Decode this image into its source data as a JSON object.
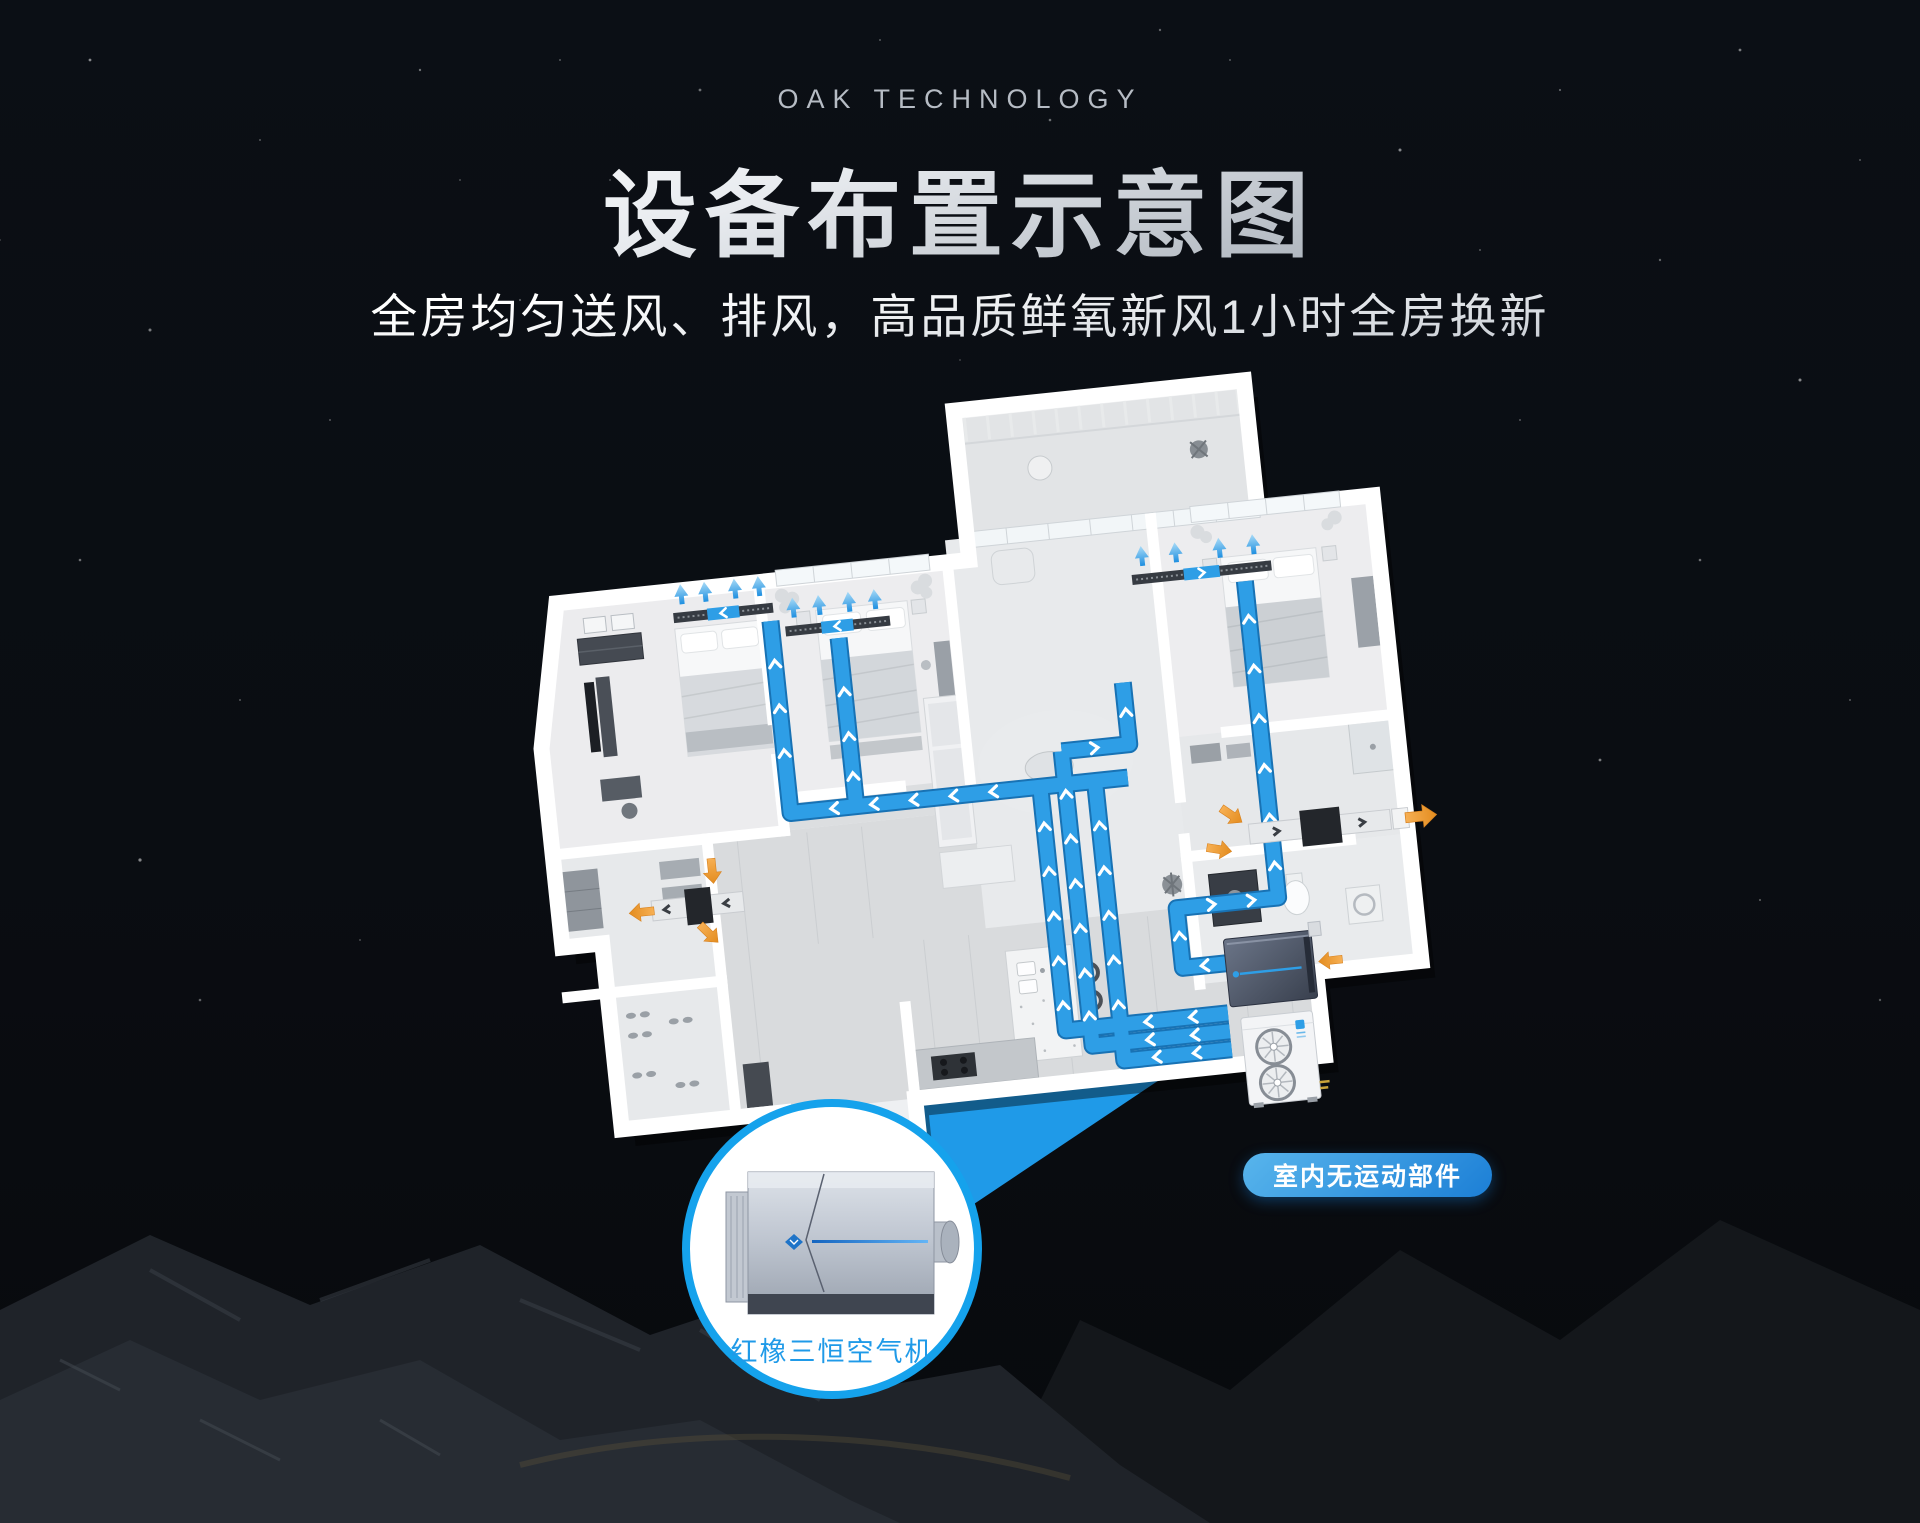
{
  "header": {
    "brand": "OAK TECHNOLOGY",
    "title": "设备布置示意图",
    "subtitle": "全房均匀送风、排风，高品质鲜氧新风1小时全房换新"
  },
  "callout": {
    "device_label": "红橡三恒空气机"
  },
  "badge": {
    "label": "室内无运动部件"
  },
  "colors": {
    "accent_blue": "#1f9ae8",
    "duct_blue": "#2e9ee6",
    "duct_edge": "#1872b4",
    "exhaust_orange": "#f09a3c",
    "badge_gradient_start": "#58b5ec",
    "badge_gradient_end": "#1c7fd6",
    "title_silver": "#c9ced6",
    "background": "#0a0d12",
    "circle_border": "#15a2ec"
  },
  "icons": {
    "supply_airflow": "blue-up-arrow",
    "exhaust_airflow": "orange-arrow",
    "duct_flow": "white-chevron",
    "outdoor_fan": "circular-fan"
  }
}
